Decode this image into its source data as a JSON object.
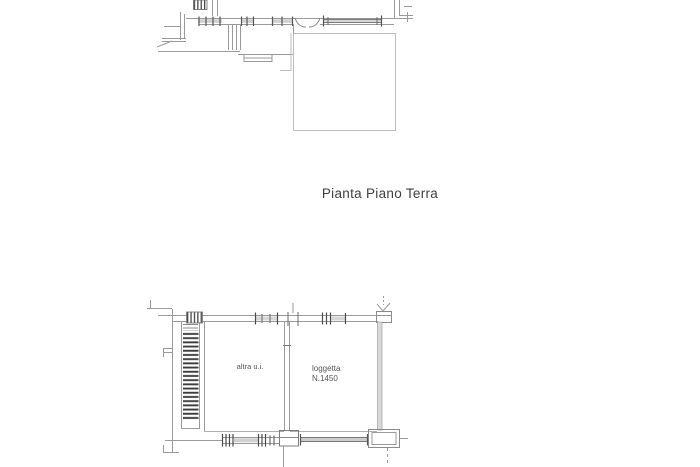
{
  "title": {
    "text": "Pianta Piano Terra"
  },
  "lower_plan": {
    "left_room_label": "altra u.i.",
    "right_room_label_line1": "loggetta",
    "right_room_label_line2": "N.1450"
  },
  "colors": {
    "line": "#9a9a9a",
    "line_light": "#bdbdbd",
    "line_dark": "#474747",
    "wall_fill": "#d9d9d9",
    "title_text": "#3f3f3f",
    "label_text": "#565656",
    "background": "#ffffff"
  }
}
